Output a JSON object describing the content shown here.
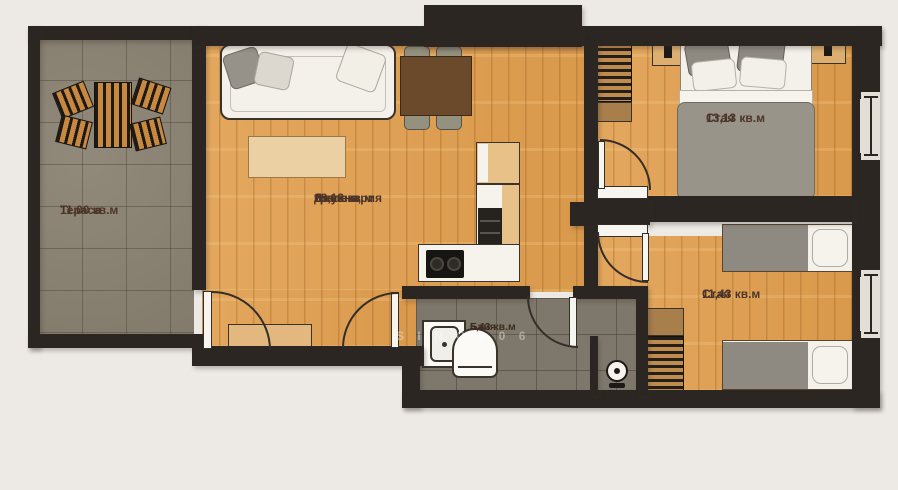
{
  "plan": {
    "rooms": [
      {
        "id": "terrace",
        "name": "Тераса",
        "area": "11.00 кв.м"
      },
      {
        "id": "living",
        "name": "Дневна, трапезария и кухня",
        "name_lines": [
          "Дневна,",
          "трапезария",
          "и кухня"
        ],
        "area": "28,13 кв.м"
      },
      {
        "id": "bedroom1",
        "name": "Стая",
        "area": "13,13 кв.м"
      },
      {
        "id": "bedroom2",
        "name": "Стая",
        "area": "11,43 кв.м"
      },
      {
        "id": "bathroom",
        "name": "Баня",
        "area": "5,43 кв.м"
      }
    ],
    "watermark": "S I N O   0 0 6",
    "colors": {
      "wall": "#2b2622",
      "wood_floor": "#dfa055",
      "terrace_tile": "#8a8272",
      "bath_tile": "#7e786c",
      "label_text": "#4c3528",
      "background": "#edeae5"
    }
  }
}
